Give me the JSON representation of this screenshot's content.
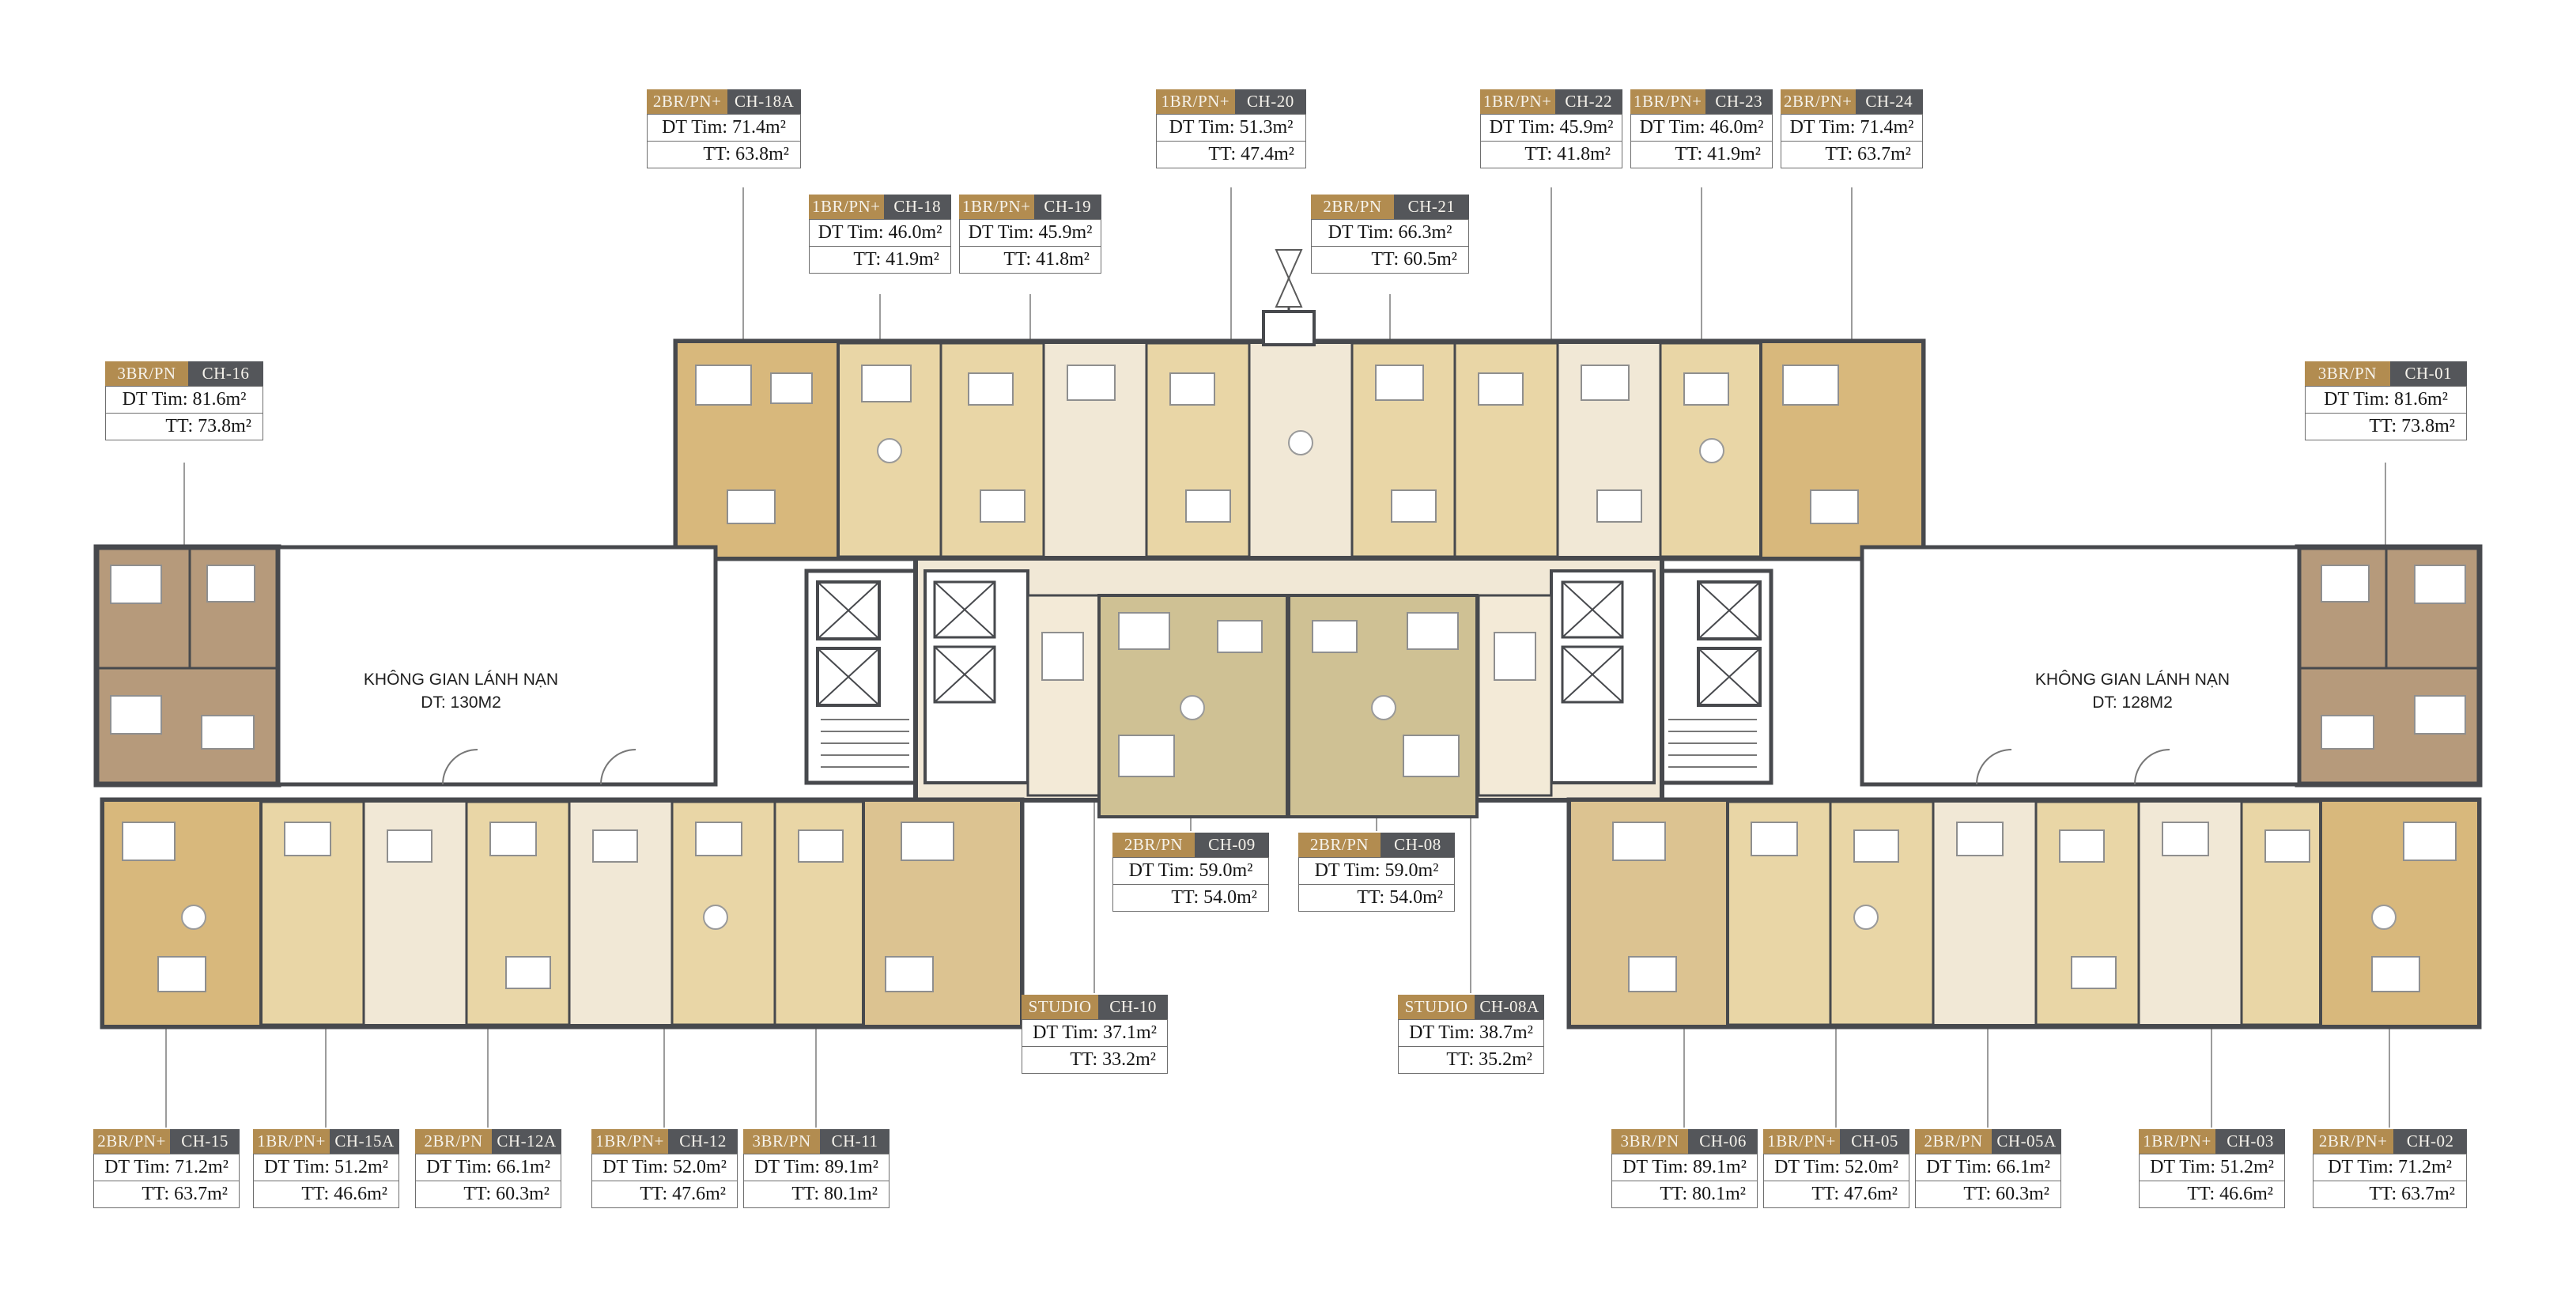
{
  "colors": {
    "type_badge": "#b28c50",
    "code_badge": "#54565a",
    "wall": "#47494d",
    "room_tan": "#e9d6a6",
    "room_gold": "#d8b87c",
    "room_khaki": "#cfc194",
    "room_cream": "#f1e8d6",
    "room_brown": "#b69a7b"
  },
  "refuge_areas": [
    {
      "name": "KHÔNG GIAN LÁNH NẠN",
      "area": "DT: 130M2"
    },
    {
      "name": "KHÔNG GIAN LÁNH NẠN",
      "area": "DT: 128M2"
    }
  ],
  "units": [
    {
      "type": "2BR/PN+",
      "code": "CH-18A",
      "dt_tim": "DT Tim: 71.4m²",
      "tt": "TT: 63.8m²"
    },
    {
      "type": "1BR/PN+",
      "code": "CH-20",
      "dt_tim": "DT Tim: 51.3m²",
      "tt": "TT: 47.4m²"
    },
    {
      "type": "1BR/PN+",
      "code": "CH-22",
      "dt_tim": "DT Tim: 45.9m²",
      "tt": "TT: 41.8m²"
    },
    {
      "type": "1BR/PN+",
      "code": "CH-23",
      "dt_tim": "DT Tim: 46.0m²",
      "tt": "TT: 41.9m²"
    },
    {
      "type": "2BR/PN+",
      "code": "CH-24",
      "dt_tim": "DT Tim: 71.4m²",
      "tt": "TT: 63.7m²"
    },
    {
      "type": "1BR/PN+",
      "code": "CH-18",
      "dt_tim": "DT Tim: 46.0m²",
      "tt": "TT: 41.9m²"
    },
    {
      "type": "1BR/PN+",
      "code": "CH-19",
      "dt_tim": "DT Tim: 45.9m²",
      "tt": "TT: 41.8m²"
    },
    {
      "type": "2BR/PN",
      "code": "CH-21",
      "dt_tim": "DT Tim: 66.3m²",
      "tt": "TT: 60.5m²"
    },
    {
      "type": "3BR/PN",
      "code": "CH-16",
      "dt_tim": "DT Tim: 81.6m²",
      "tt": "TT: 73.8m²"
    },
    {
      "type": "3BR/PN",
      "code": "CH-01",
      "dt_tim": "DT Tim: 81.6m²",
      "tt": "TT: 73.8m²"
    },
    {
      "type": "2BR/PN",
      "code": "CH-09",
      "dt_tim": "DT Tim: 59.0m²",
      "tt": "TT: 54.0m²"
    },
    {
      "type": "2BR/PN",
      "code": "CH-08",
      "dt_tim": "DT Tim: 59.0m²",
      "tt": "TT: 54.0m²"
    },
    {
      "type": "STUDIO",
      "code": "CH-10",
      "dt_tim": "DT Tim: 37.1m²",
      "tt": "TT: 33.2m²"
    },
    {
      "type": "STUDIO",
      "code": "CH-08A",
      "dt_tim": "DT Tim: 38.7m²",
      "tt": "TT: 35.2m²"
    },
    {
      "type": "2BR/PN+",
      "code": "CH-15",
      "dt_tim": "DT Tim: 71.2m²",
      "tt": "TT: 63.7m²"
    },
    {
      "type": "1BR/PN+",
      "code": "CH-15A",
      "dt_tim": "DT Tim: 51.2m²",
      "tt": "TT: 46.6m²"
    },
    {
      "type": "2BR/PN",
      "code": "CH-12A",
      "dt_tim": "DT Tim: 66.1m²",
      "tt": "TT: 60.3m²"
    },
    {
      "type": "1BR/PN+",
      "code": "CH-12",
      "dt_tim": "DT Tim: 52.0m²",
      "tt": "TT: 47.6m²"
    },
    {
      "type": "3BR/PN",
      "code": "CH-11",
      "dt_tim": "DT Tim: 89.1m²",
      "tt": "TT: 80.1m²"
    },
    {
      "type": "3BR/PN",
      "code": "CH-06",
      "dt_tim": "DT Tim: 89.1m²",
      "tt": "TT: 80.1m²"
    },
    {
      "type": "1BR/PN+",
      "code": "CH-05",
      "dt_tim": "DT Tim: 52.0m²",
      "tt": "TT: 47.6m²"
    },
    {
      "type": "2BR/PN",
      "code": "CH-05A",
      "dt_tim": "DT Tim: 66.1m²",
      "tt": "TT: 60.3m²"
    },
    {
      "type": "1BR/PN+",
      "code": "CH-03",
      "dt_tim": "DT Tim: 51.2m²",
      "tt": "TT: 46.6m²"
    },
    {
      "type": "2BR/PN+",
      "code": "CH-02",
      "dt_tim": "DT Tim: 71.2m²",
      "tt": "TT: 63.7m²"
    }
  ]
}
